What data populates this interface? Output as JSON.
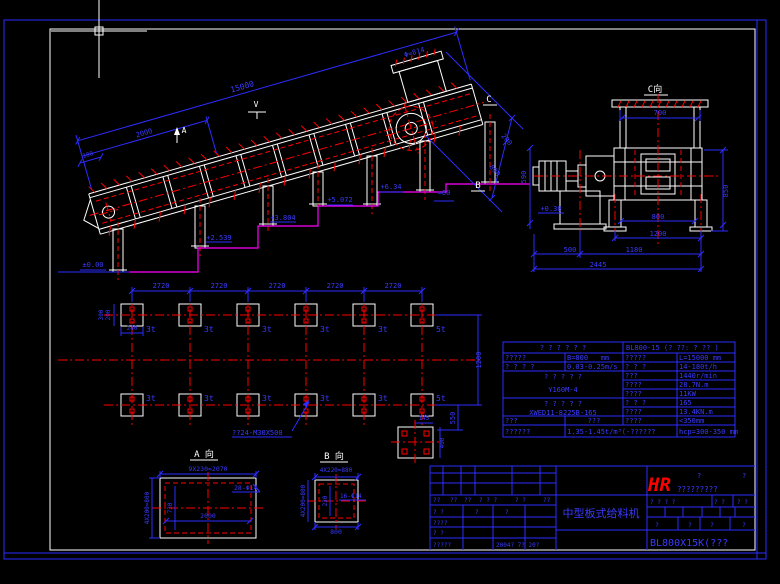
{
  "colors": {
    "background": "#000000",
    "line_white": "#ffffff",
    "line_blue": "#2d2dff",
    "line_red": "#ff0000",
    "line_magenta": "#ff00ff",
    "logo_red": "#ff0000"
  },
  "main_view": {
    "dim_15000": "15000",
    "dim_2000": "2000",
    "dim_100": "100",
    "hopper_dia": "Φ≈814",
    "label_a": "A",
    "label_v": "V",
    "label_c": "C",
    "label_b": "B",
    "dim_200": "200",
    "dim_800": "800",
    "approx_60": "≈60",
    "lvl_000": "±0.00",
    "lvl_2539": "+2.539",
    "lvl_3804": "+3.804",
    "lvl_5072": "+5.072",
    "lvl_634": "+6.34"
  },
  "c_view": {
    "title": "C向",
    "dim_700": "700",
    "dim_590": "590",
    "lvl_038": "+0.38",
    "dim_800": "800",
    "dim_1200": "1200",
    "dim_500": "500",
    "dim_1180": "1180",
    "dim_2445": "2445",
    "dim_850": "850"
  },
  "plan": {
    "bay_dims": [
      "2720",
      "2720",
      "2720",
      "2720",
      "2720"
    ],
    "loads_top": [
      "3t",
      "3t",
      "3t",
      "3t",
      "3t",
      "5t"
    ],
    "loads_bottom": [
      "3t",
      "3t",
      "3t",
      "3t",
      "3t",
      "5t"
    ],
    "dim_300": "300",
    "dim_200": "200",
    "dim_240": "240",
    "dim_1200": "1200",
    "dim_550": "550",
    "dim_145": "145",
    "dim_400": "400",
    "anchor_note": "??24-M30X500"
  },
  "detail_a": {
    "title": "A 向",
    "dim_top": "9X230=2070",
    "dim_left": "4X200=800",
    "dim_730": "730",
    "dim_2000": "2000",
    "holes": "28-Φ14"
  },
  "detail_b": {
    "title": "B 向",
    "dim_top": "4X220=880",
    "dim_left": "4X200=800",
    "dim_230": "230",
    "dim_800": "800",
    "holes": "16-Φ14"
  },
  "param_table": {
    "header_left": "? ? ? ? ? ?",
    "header_right": "BL800-15 (? ??: ? ?? )",
    "r2c1": "?????",
    "r2c2": "B=800   mm",
    "r2c3": "?????",
    "r2c4": "L=15000 mm",
    "r3c1": "? ? ? ?",
    "r3c2": "0.03-0.25m/s",
    "r3c3": "? ? ?",
    "r3c4": "14-180t/h",
    "motor_label": "? ? ? ? ?",
    "motor_model": "Y160M-4",
    "m1l": "???",
    "m1v": "1440r/min",
    "m2l": "????",
    "m2v": "28.7N.m",
    "m3l": "????",
    "m3v": "11KW",
    "reducer_label": "? ? ? ? ?",
    "reducer_model": "XWED11-8225B-165",
    "x1l": "? ? ?",
    "x1v": "165",
    "x2l": "????",
    "x2v": "13.4KN.m",
    "r9c1": "???",
    "r9c2": "???",
    "r9c3": "????",
    "r9c4": "<350mm",
    "r10c1": "??????",
    "r10c2": "1.35-1.45t/m³(-??????",
    "r10c4": "hcp=300-350 mm"
  },
  "title_block": {
    "rev_headers": [
      "??",
      "??",
      "??",
      "? ? ?",
      "? ?",
      "??"
    ],
    "row1": [
      "? ?",
      "?",
      "?"
    ],
    "row2": "????",
    "row3": "? ?",
    "row4_label": "?????",
    "date": "2004? 7? 20?",
    "product_name": "中型板式给料机",
    "logo_hr": "HR",
    "logo_q1": "?",
    "logo_q2": "?",
    "logo_text": "?????????",
    "grid_headers": [
      "? ? ? ?",
      "? ?",
      "? ?"
    ],
    "grid_row": [
      "?",
      "?",
      "?",
      "?"
    ],
    "drawing_no": "BL800X15K(???"
  }
}
